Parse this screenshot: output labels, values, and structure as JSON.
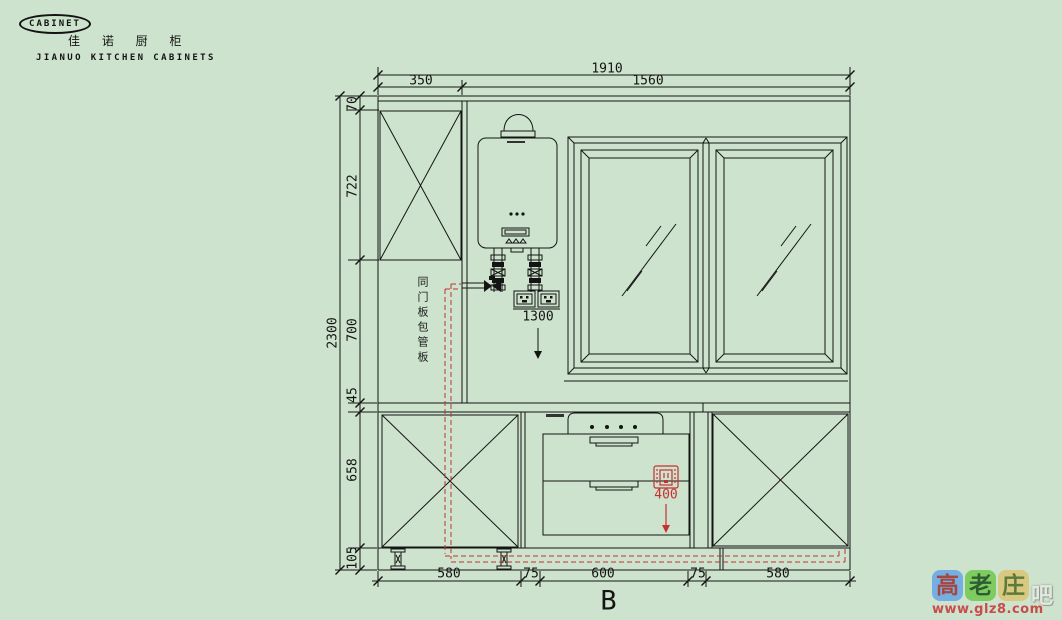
{
  "logo": {
    "badge": "CABINET",
    "title_cn": "佳 诺 厨 柜",
    "title_en": "JIANUO KITCHEN CABINETS"
  },
  "dimensions": {
    "top": {
      "total": "1910",
      "seg1": "350",
      "seg2": "1560"
    },
    "left": {
      "total": "2300",
      "segments": [
        "70",
        "722",
        "700",
        "45",
        "658",
        "105"
      ]
    },
    "bottom": {
      "segments": [
        "580",
        "75",
        "600",
        "75",
        "580"
      ]
    }
  },
  "annotations": {
    "pipe_panel_note": "同门板包管板",
    "socket_height": "1300",
    "stove_socket_height": "400",
    "view_label": "B"
  },
  "watermark": {
    "tiles": [
      {
        "char": "高"
      },
      {
        "char": "老"
      },
      {
        "char": "庄"
      }
    ],
    "suffix": "吧",
    "url": "www.glz8.com"
  },
  "colors": {
    "background": "#cde3cd",
    "line": "#141414",
    "red": "#c43232"
  }
}
